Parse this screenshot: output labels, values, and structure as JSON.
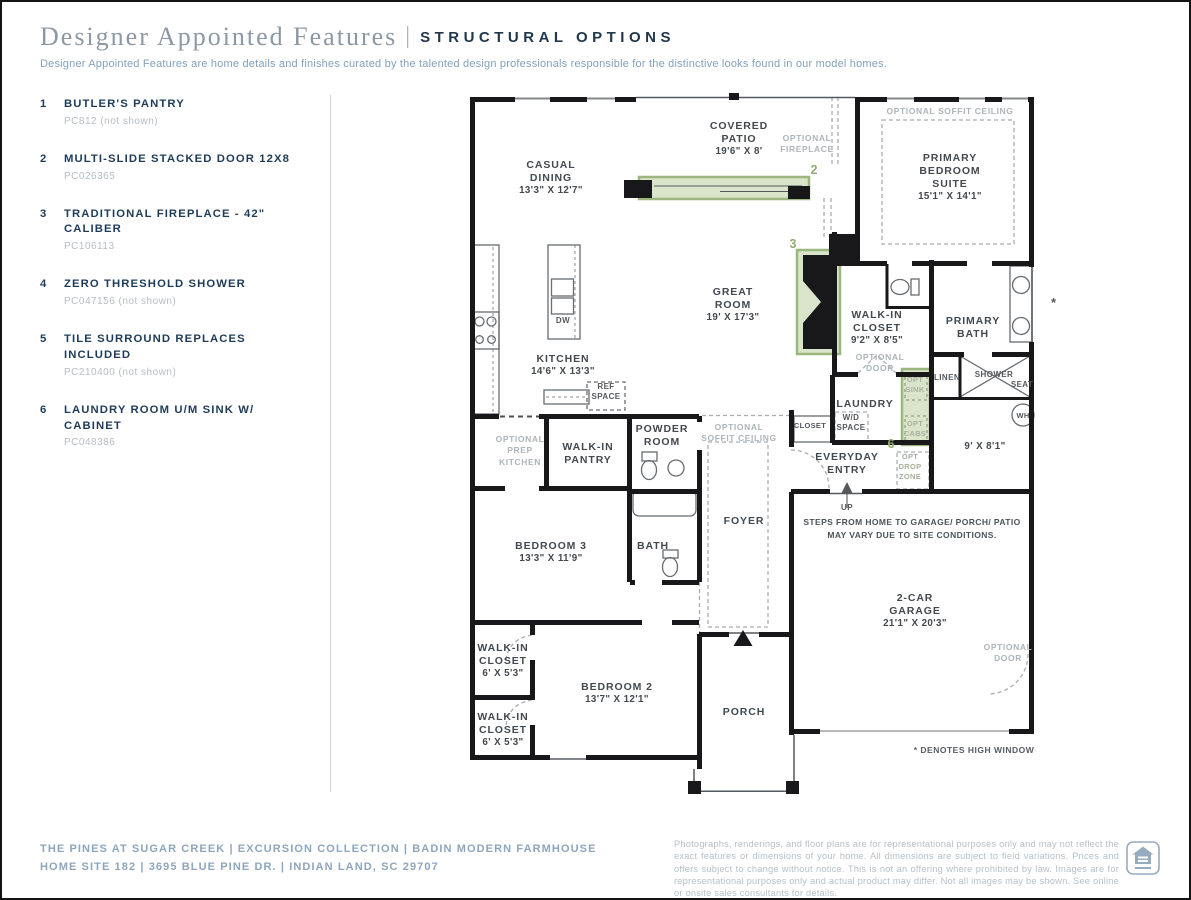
{
  "header": {
    "title": "Designer Appointed Features",
    "separator": "|",
    "tag": "STRUCTURAL OPTIONS",
    "description": "Designer Appointed Features are home details and finishes curated by the talented design professionals responsible for the distinctive looks found in our model homes."
  },
  "features": [
    {
      "num": "1",
      "title": "BUTLER'S PANTRY",
      "code": "PC812 (not shown)"
    },
    {
      "num": "2",
      "title": "MULTI-SLIDE STACKED DOOR 12X8",
      "code": "PC026365"
    },
    {
      "num": "3",
      "title": "TRADITIONAL FIREPLACE - 42\" CALIBER",
      "code": "PC106113"
    },
    {
      "num": "4",
      "title": "ZERO THRESHOLD SHOWER",
      "code": "PC047156 (not shown)"
    },
    {
      "num": "5",
      "title": "TILE SURROUND REPLACES INCLUDED",
      "code": "PC210400 (not shown)"
    },
    {
      "num": "6",
      "title": "LAUNDRY ROOM U/M SINK W/ CABINET",
      "code": "PC048386"
    }
  ],
  "floorplan": {
    "labels": {
      "casual_dining": [
        "CASUAL",
        "DINING",
        "13'3\" X 12'7\""
      ],
      "covered_patio": [
        "COVERED",
        "PATIO",
        "19'6\" X 8'"
      ],
      "primary_bedroom": [
        "PRIMARY",
        "BEDROOM",
        "SUITE",
        "15'1\" X 14'1\""
      ],
      "soffit_primary": [
        "OPTIONAL SOFFIT CEILING"
      ],
      "optional_fireplace": [
        "OPTIONAL",
        "FIREPLACE"
      ],
      "great_room": [
        "GREAT",
        "ROOM",
        "19' X 17'3\""
      ],
      "kitchen": [
        "KITCHEN",
        "14'6\" X 13'3\""
      ],
      "dw": [
        "DW"
      ],
      "ref_space": [
        "REF",
        "SPACE"
      ],
      "walk_in_pantry": [
        "WALK-IN",
        "PANTRY"
      ],
      "prep_kitchen": [
        "OPTIONAL",
        "PREP",
        "KITCHEN"
      ],
      "powder_room": [
        "POWDER",
        "ROOM"
      ],
      "soffit_foyer": [
        "OPTIONAL",
        "SOFFIT CEILING"
      ],
      "foyer": [
        "FOYER"
      ],
      "bedroom3": [
        "BEDROOM 3",
        "13'3\" X 11'9\""
      ],
      "bath": [
        "BATH"
      ],
      "wic_bed1": [
        "WALK-IN",
        "CLOSET",
        "6' X 5'3\""
      ],
      "wic_bed2": [
        "WALK-IN",
        "CLOSET",
        "6' X 5'3\""
      ],
      "bedroom2": [
        "BEDROOM 2",
        "13'7\" X 12'1\""
      ],
      "porch": [
        "PORCH"
      ],
      "wic_primary": [
        "WALK-IN",
        "CLOSET",
        "9'2\" X 8'5\""
      ],
      "optional_door_closet": [
        "OPTIONAL",
        "DOOR"
      ],
      "primary_bath": [
        "PRIMARY",
        "BATH"
      ],
      "linen": [
        "LINEN"
      ],
      "shower": [
        "SHOWER"
      ],
      "seat": [
        "SEAT"
      ],
      "water_heater": [
        "WH"
      ],
      "flex_room": [
        "9' X 8'1\""
      ],
      "laundry": [
        "LAUNDRY"
      ],
      "wd_space": [
        "W/D",
        "SPACE"
      ],
      "closet": [
        "CLOSET"
      ],
      "opt_sink": [
        "OPT",
        "SINK"
      ],
      "opt_cabs": [
        "OPT",
        "CABS"
      ],
      "everyday_entry": [
        "EVERYDAY",
        "ENTRY"
      ],
      "opt_drop_zone": [
        "OPT",
        "DROP",
        "ZONE"
      ],
      "up": [
        "UP"
      ],
      "steps_note": [
        "STEPS FROM HOME TO GARAGE/ PORCH/  PATIO",
        "MAY VARY DUE TO SITE CONDITIONS."
      ],
      "garage": [
        "2-CAR",
        "GARAGE",
        "21'1\" X 20'3\""
      ],
      "optional_door_garage": [
        "OPTIONAL",
        "DOOR"
      ],
      "high_window_note": [
        "* DENOTES HIGH WINDOW"
      ],
      "high_window_star": [
        "*"
      ]
    },
    "markers": {
      "multi_slide_door": "2",
      "fireplace": "3",
      "laundry_sink": "6"
    }
  },
  "footer": {
    "line1": "THE PINES AT SUGAR CREEK  |  EXCURSION COLLECTION  |  BADIN MODERN FARMHOUSE",
    "line2": "HOME SITE 182  |  3695 BLUE PINE DR.  |  INDIAN LAND, SC 29707",
    "disclaimer": "Photographs, renderings, and floor plans are for representational purposes only and may not reflect the exact features or dimensions of your home. All dimensions are subject to field variations. Prices and offers subject to change without notice. This is not an offering where prohibited by law. Images are for representational purposes only and actual product may differ. Not all images may be shown. See online or onsite sales consultants for details.",
    "logo": "equal-housing-logo"
  },
  "colors": {
    "navy": "#1e3c59",
    "accent_green": "#9cb77e",
    "green_fill": "#aac48a",
    "serif_gray": "#8c98a4",
    "footer_blue": "#8ea6bd"
  }
}
